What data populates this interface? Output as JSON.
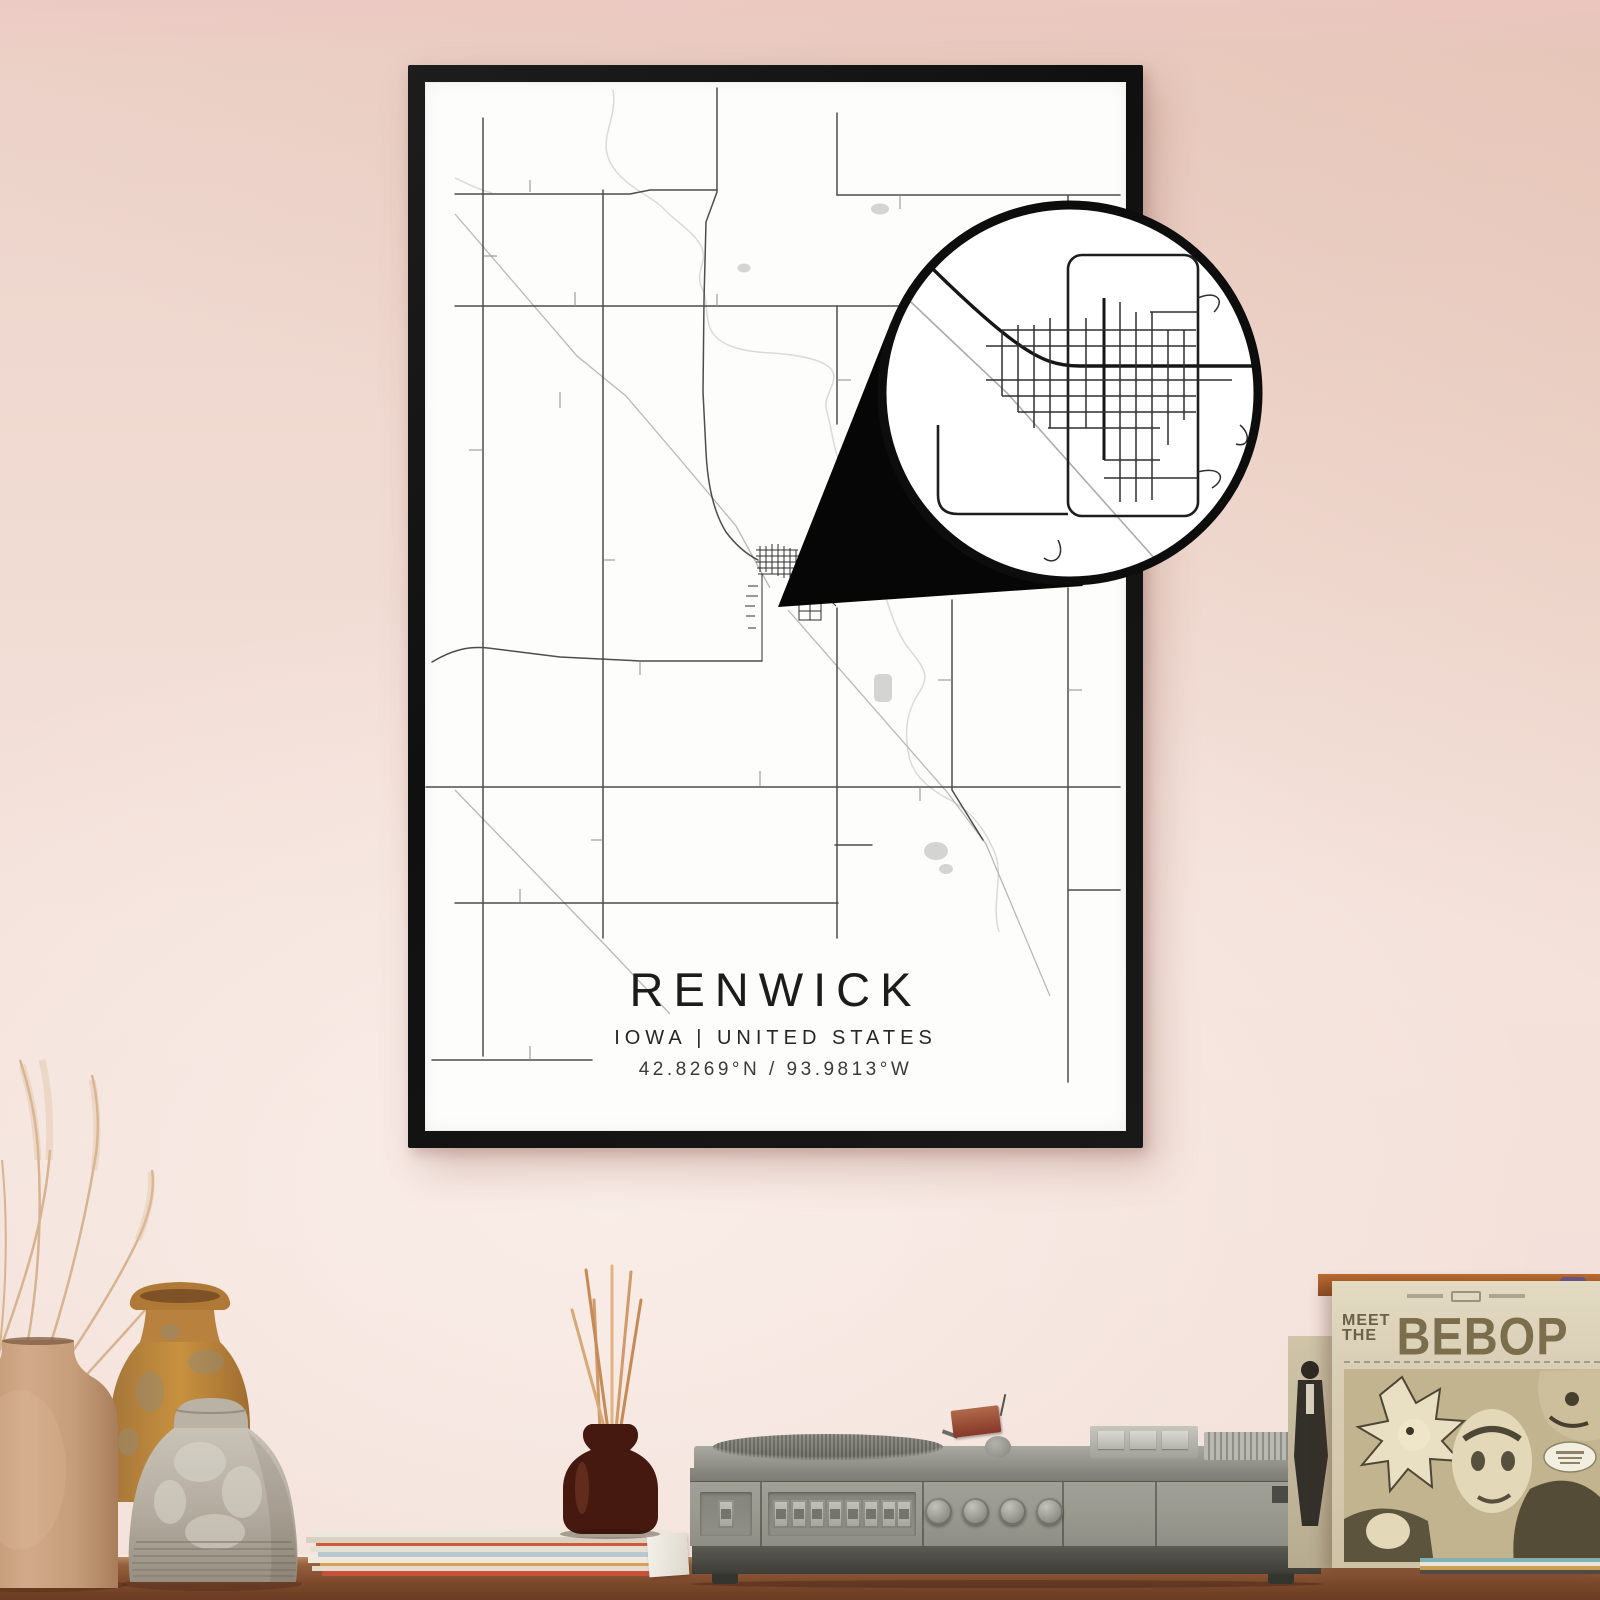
{
  "poster": {
    "title": "RENWICK",
    "subtitle": "IOWA | UNITED STATES",
    "coordinates": "42.8269°N / 93.9813°W"
  },
  "album": {
    "word1": "MEET",
    "word2": "THE",
    "title": "BEBOP"
  },
  "colors": {
    "wall": "#f2dfd8",
    "frame": "#141414",
    "poster_paper": "#fdfdfc",
    "map_road": "#3a3a3a",
    "map_railroad": "#b8b8b8",
    "map_river": "#dadada",
    "magnifier_ring": "#0d0d0d",
    "shelf_wood": "#7c492c",
    "player_gray": "#9c9c95",
    "sleeve_cream": "#d9cfb6",
    "sleeve_ink": "#6f6449",
    "diffuser_glass": "#4a2014",
    "stick_orange": "#d09a6a"
  }
}
